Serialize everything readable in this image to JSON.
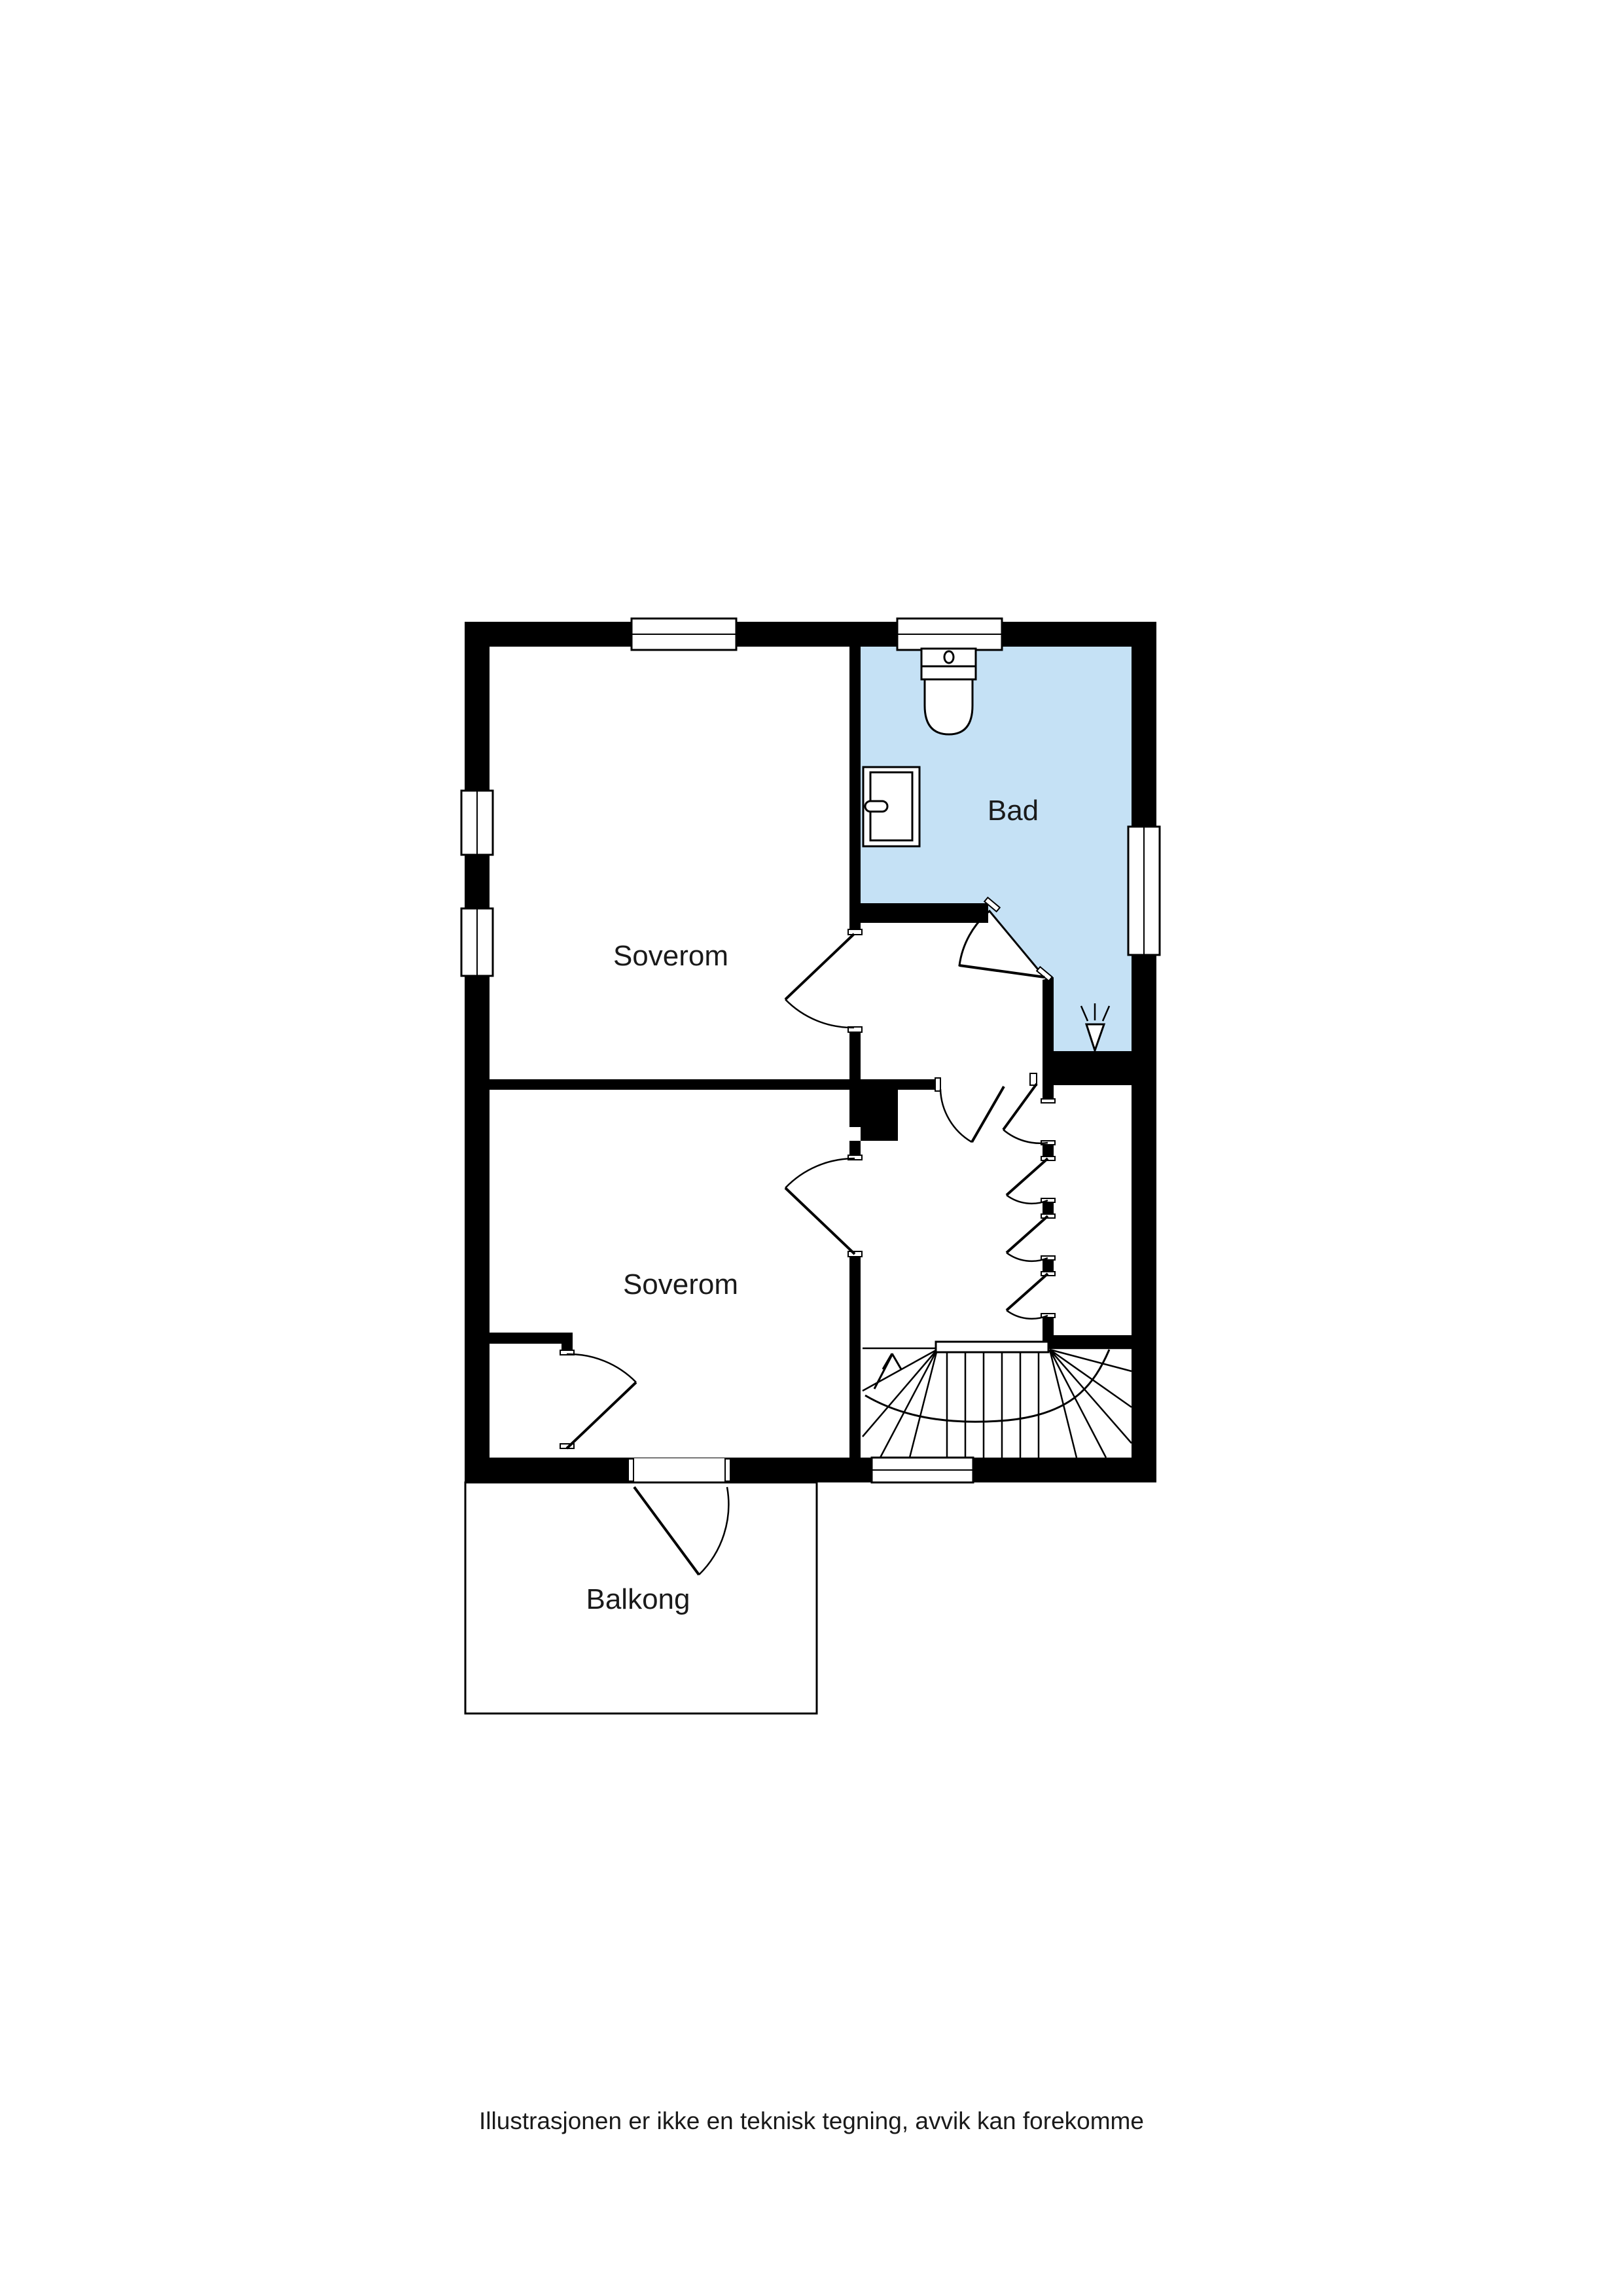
{
  "title": "Floor plan - second storey",
  "rooms": [
    {
      "id": "soverom-1",
      "label": "Soverom"
    },
    {
      "id": "bad",
      "label": "Bad"
    },
    {
      "id": "soverom-2",
      "label": "Soverom"
    },
    {
      "id": "balkong",
      "label": "Balkong"
    }
  ],
  "disclaimer": "Illustrasjonen er ikke en teknisk tegning, avvik kan forekomme",
  "colors": {
    "bathroom_fill": "#c5e1f5",
    "wall": "#000000",
    "background": "#ffffff"
  },
  "fixtures": [
    {
      "name": "toilet"
    },
    {
      "name": "sink"
    },
    {
      "name": "shower-symbol"
    },
    {
      "name": "staircase"
    },
    {
      "name": "stair-direction-arrow"
    }
  ]
}
